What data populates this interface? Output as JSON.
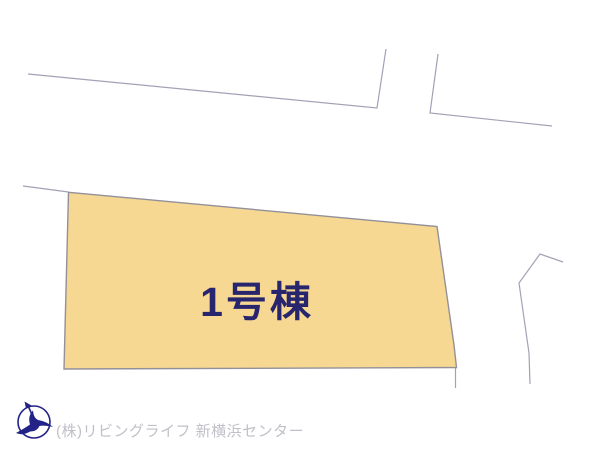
{
  "canvas": {
    "width": 600,
    "height": 450,
    "background": "#ffffff"
  },
  "site_plan": {
    "lot": {
      "label": "1号棟",
      "fill": "#f6d892",
      "stroke": "#93909a",
      "label_color": "#26256d"
    },
    "road_line_color": "#a2a2b6"
  },
  "footer": {
    "logo_icon": "bird-compass-logo",
    "logo_color": "#232387",
    "company": "(株)リビングライフ 新横浜センター",
    "text_color": "#c0c0c9"
  }
}
